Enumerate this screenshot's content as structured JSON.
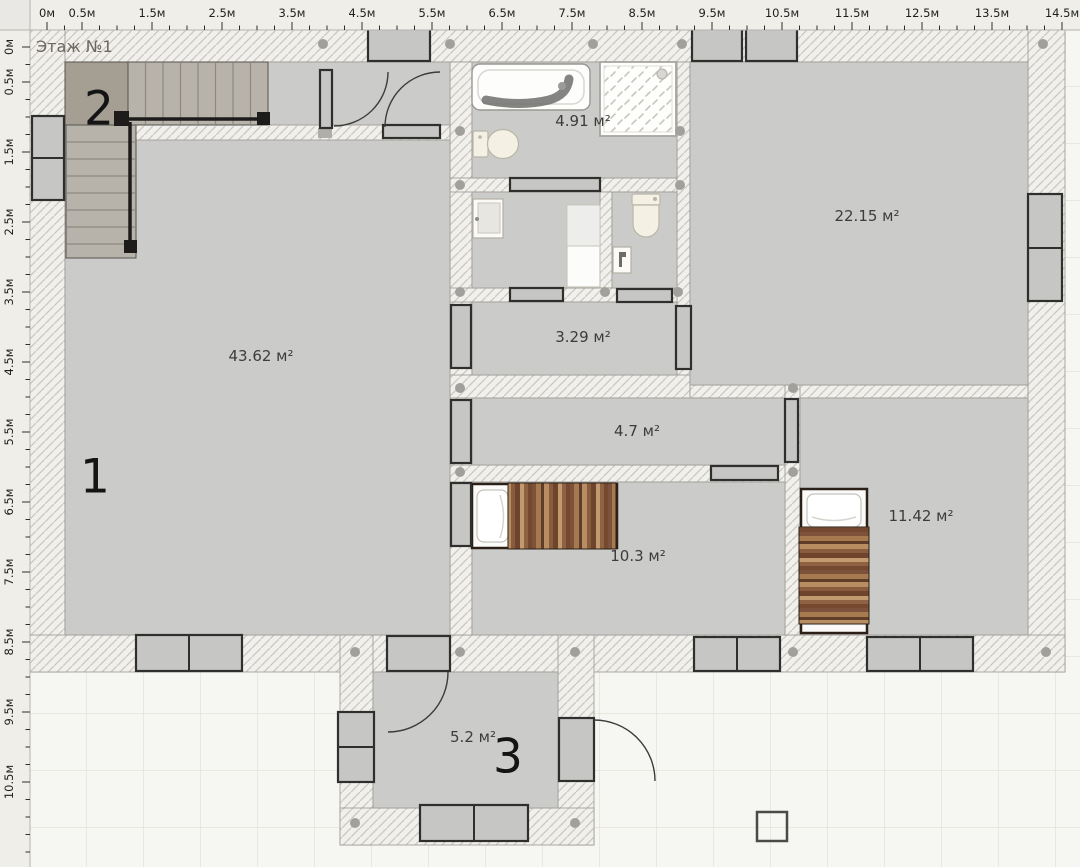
{
  "app": {
    "floor_label": "Этаж №1"
  },
  "rulers": {
    "unit": "м",
    "px_per_meter": 70,
    "origin_px": 47,
    "tick_step_m": 0.25,
    "top_max_m": 14.6,
    "left_max_m": 11.6,
    "top": [
      {
        "t": "0м",
        "m": 0
      },
      {
        "t": "0.5м",
        "m": 0.5
      },
      {
        "t": "1.5м",
        "m": 1.5
      },
      {
        "t": "2.5м",
        "m": 2.5
      },
      {
        "t": "3.5м",
        "m": 3.5
      },
      {
        "t": "4.5м",
        "m": 4.5
      },
      {
        "t": "5.5м",
        "m": 5.5
      },
      {
        "t": "6.5м",
        "m": 6.5
      },
      {
        "t": "7.5м",
        "m": 7.5
      },
      {
        "t": "8.5м",
        "m": 8.5
      },
      {
        "t": "9.5м",
        "m": 9.5
      },
      {
        "t": "10.5м",
        "m": 10.5
      },
      {
        "t": "11.5м",
        "m": 11.5
      },
      {
        "t": "12.5м",
        "m": 12.5
      },
      {
        "t": "13.5м",
        "m": 13.5
      },
      {
        "t": "14.5м",
        "m": 14.5
      }
    ],
    "left": [
      {
        "t": "0м",
        "m": 0
      },
      {
        "t": "0.5м",
        "m": 0.5
      },
      {
        "t": "1.5м",
        "m": 1.5
      },
      {
        "t": "2.5м",
        "m": 2.5
      },
      {
        "t": "3.5м",
        "m": 3.5
      },
      {
        "t": "4.5м",
        "m": 4.5
      },
      {
        "t": "5.5м",
        "m": 5.5
      },
      {
        "t": "6.5м",
        "m": 6.5
      },
      {
        "t": "7.5м",
        "m": 7.5
      },
      {
        "t": "8.5м",
        "m": 8.5
      },
      {
        "t": "9.5м",
        "m": 9.5
      },
      {
        "t": "10.5м",
        "m": 10.5
      }
    ]
  },
  "plan": {
    "colors": {
      "floor": "#cbcbc9",
      "wall_bg": "#f1f0ec",
      "wall_hatch_line": "#cbc8c1",
      "outside_bg": "#f6f6f2",
      "grid_line": "#e1dfd4",
      "window_fill": "#c6c6c4",
      "frame_stroke": "#2f2f2d",
      "node": "#a2a09c",
      "bed_frame": "#2a2018",
      "marker_text": "#141414",
      "label_text": "#3c3c3a"
    },
    "room_labels": [
      {
        "name": "living-room",
        "text": "43.62 м²",
        "x": 261,
        "y": 356
      },
      {
        "name": "bathroom",
        "text": "4.91 м²",
        "x": 583,
        "y": 121
      },
      {
        "name": "bedroom-large",
        "text": "22.15 м²",
        "x": 867,
        "y": 216
      },
      {
        "name": "hall-small",
        "text": "3.29 м²",
        "x": 583,
        "y": 337
      },
      {
        "name": "corridor",
        "text": "4.7 м²",
        "x": 637,
        "y": 431
      },
      {
        "name": "bedroom-left",
        "text": "10.3 м²",
        "x": 638,
        "y": 556
      },
      {
        "name": "bedroom-right",
        "text": "11.42 м²",
        "x": 921,
        "y": 516
      },
      {
        "name": "entry-hall",
        "text": "5.2 м²",
        "x": 473,
        "y": 737
      }
    ],
    "markers": [
      {
        "text": "1",
        "x": 95,
        "y": 477
      },
      {
        "text": "2",
        "x": 99,
        "y": 109
      },
      {
        "text": "3",
        "x": 508,
        "y": 757
      }
    ],
    "nodes": [
      [
        323,
        44
      ],
      [
        450,
        44
      ],
      [
        593,
        44
      ],
      [
        682,
        44
      ],
      [
        1043,
        44
      ],
      [
        460,
        131
      ],
      [
        460,
        185
      ],
      [
        460,
        292
      ],
      [
        460,
        388
      ],
      [
        460,
        472
      ],
      [
        460,
        652
      ],
      [
        680,
        131
      ],
      [
        680,
        185
      ],
      [
        605,
        292
      ],
      [
        678,
        292
      ],
      [
        793,
        388
      ],
      [
        793,
        472
      ],
      [
        793,
        652
      ],
      [
        355,
        652
      ],
      [
        575,
        652
      ],
      [
        1046,
        652
      ],
      [
        355,
        823
      ],
      [
        575,
        823
      ]
    ]
  }
}
